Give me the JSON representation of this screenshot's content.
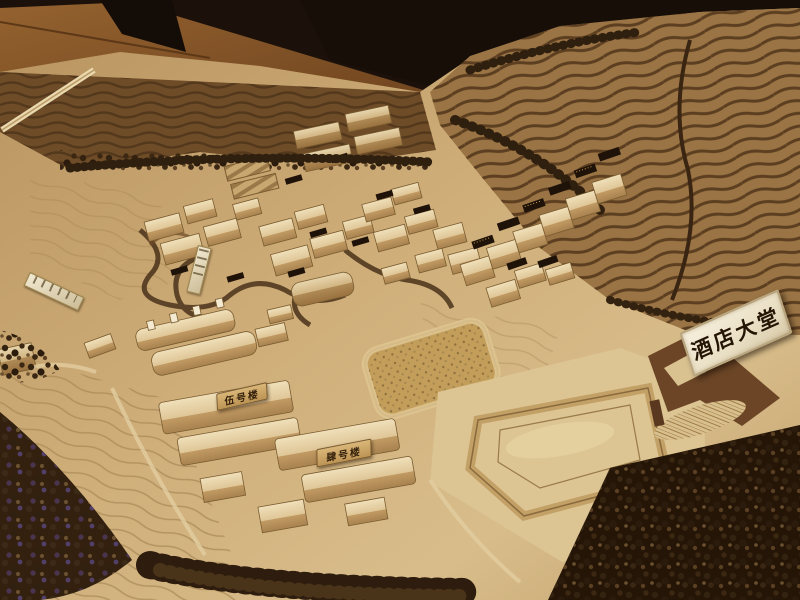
{
  "signs": {
    "hotel_lobby": "酒店大堂",
    "building_5": "伍号楼",
    "building_4": "肆号楼"
  },
  "colors": {
    "background_dark": "#1c110a",
    "wood_floor": "#8a5a2c",
    "sand_base": "#c9a873",
    "sand_light": "#dcc493",
    "upland_dark": "#6e4c28",
    "hill_terrace": "#9a7444",
    "contour_line": "#4f351a",
    "stream": "#4a321a",
    "tree_dark": "#2e1d0e",
    "tree_purple_speck": "#53406a",
    "building_light": "#ead9b2",
    "building_shadow": "#b5925e",
    "placard_dark": "#1f1208",
    "sign_background": "#f3ecda",
    "sign_text": "#241505"
  }
}
